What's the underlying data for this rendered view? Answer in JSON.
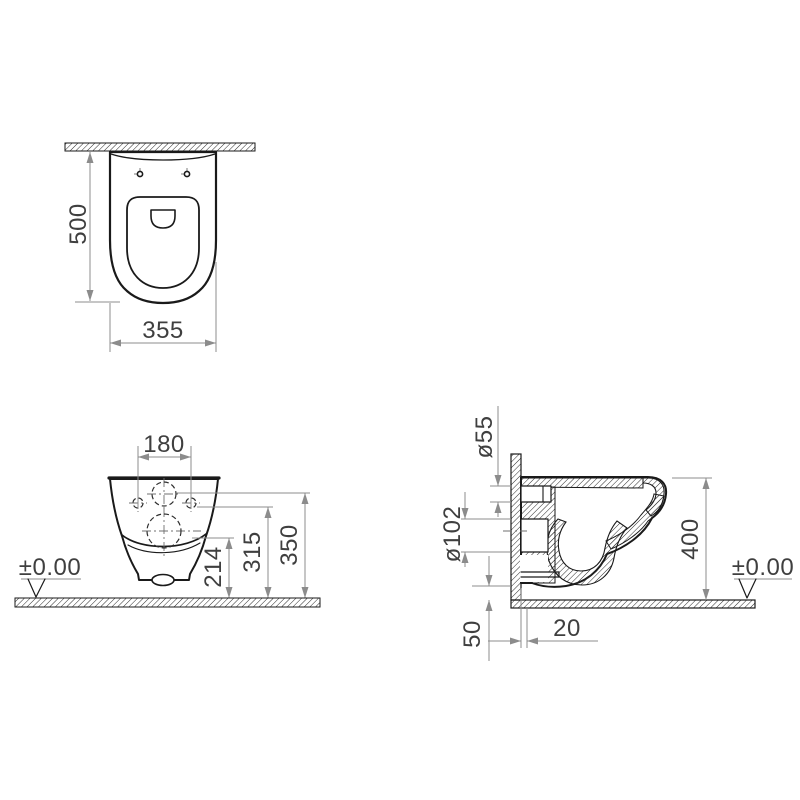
{
  "drawing": {
    "type": "wall-hung-toilet-technical-drawing",
    "units": "mm",
    "colors": {
      "outline": "#1a1a1a",
      "dimension_lines": "#8c8c8c",
      "text": "#3f3f3f",
      "background": "#ffffff"
    },
    "views": {
      "top": {
        "label": "plan-view",
        "dim_depth": "500",
        "dim_width": "355"
      },
      "front": {
        "label": "front-view",
        "dim_hole_spacing": "180",
        "dim_outlet_center_height": "214",
        "dim_inlet_center_height": "315",
        "dim_fixing_height": "350",
        "datum": "±0.00"
      },
      "side": {
        "label": "side-section-view",
        "dim_inlet_diameter": "ø55",
        "dim_outlet_diameter": "ø102",
        "dim_overall_height": "400",
        "dim_bottom_gap": "50",
        "dim_wall_offset": "20",
        "datum": "±0.00"
      }
    }
  }
}
